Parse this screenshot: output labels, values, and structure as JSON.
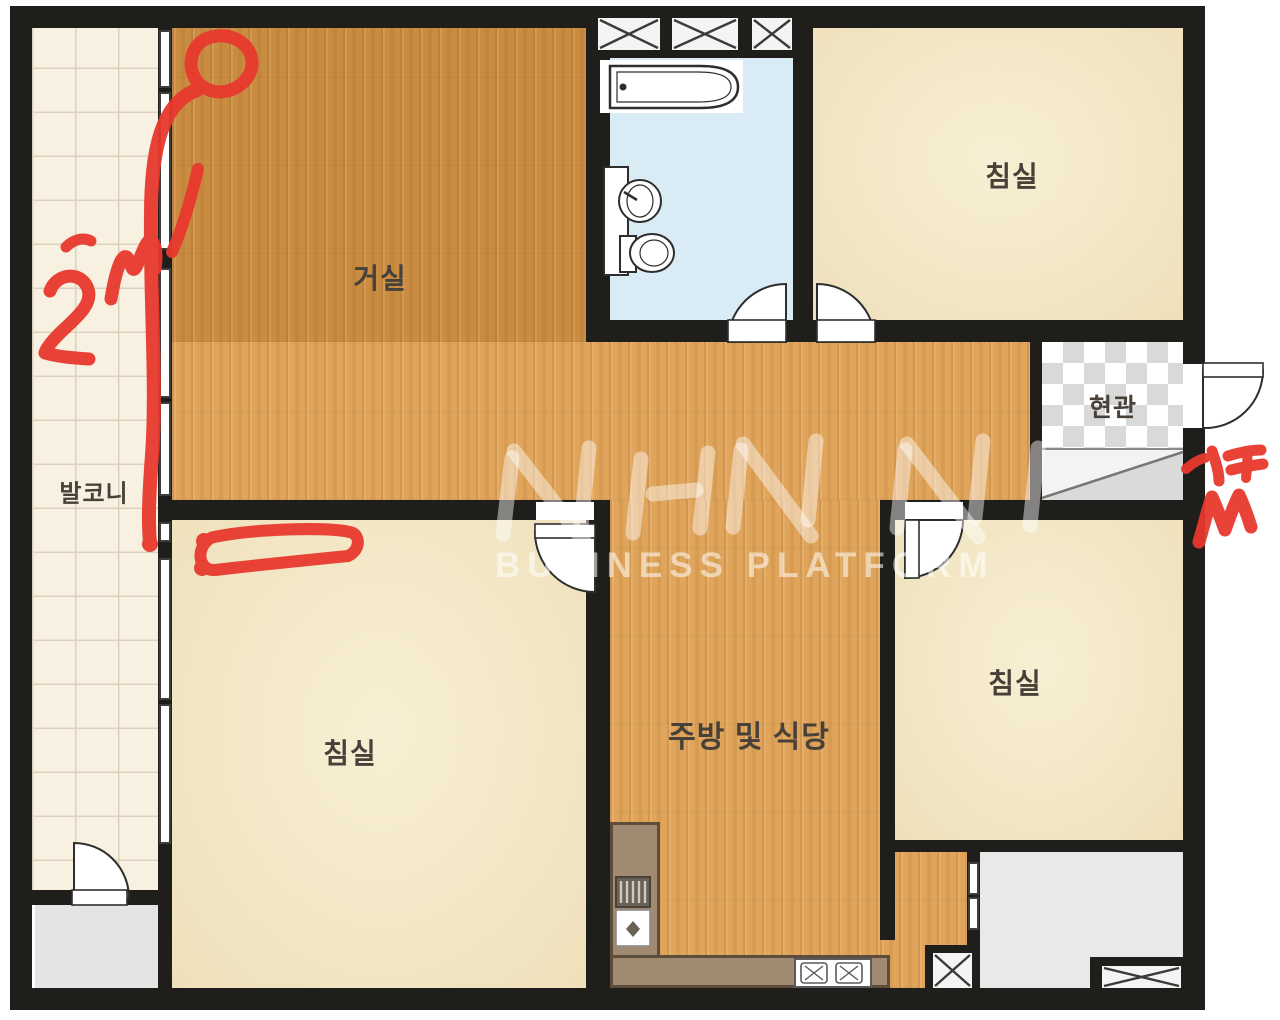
{
  "rooms": {
    "living_room": {
      "label": "거실"
    },
    "bedroom_top_right": {
      "label": "침실"
    },
    "bedroom_bottom_left": {
      "label": "침실"
    },
    "bedroom_right": {
      "label": "침실"
    },
    "kitchen_dining": {
      "label": "주방 및 식당"
    },
    "balcony": {
      "label": "발코니"
    },
    "entrance": {
      "label": "현관"
    }
  },
  "watermark": {
    "logo": "NHN",
    "subtitle": "BUSINESS PLATFORM"
  },
  "annotations": {
    "ink_color": "#e8392e",
    "measurement_text": "2m",
    "items": [
      "circled-area-top",
      "vertical-measure-line-on-balcony-window",
      "2m-handwriting",
      "box-highlight-in-bedroom",
      "scribble-next-to-entrance-door"
    ]
  },
  "colors": {
    "wall": "#201e1b",
    "wood_dark": "#c98c41",
    "wood_light": "#e0a45a",
    "bedroom_floor": "#f2e7c6",
    "bathroom_floor": "#d9ebf4",
    "balcony_floor": "#f8f1e1",
    "counter": "#a08b72",
    "utility_floor": "#e6e6e6",
    "annotation_red": "#e8392e"
  }
}
